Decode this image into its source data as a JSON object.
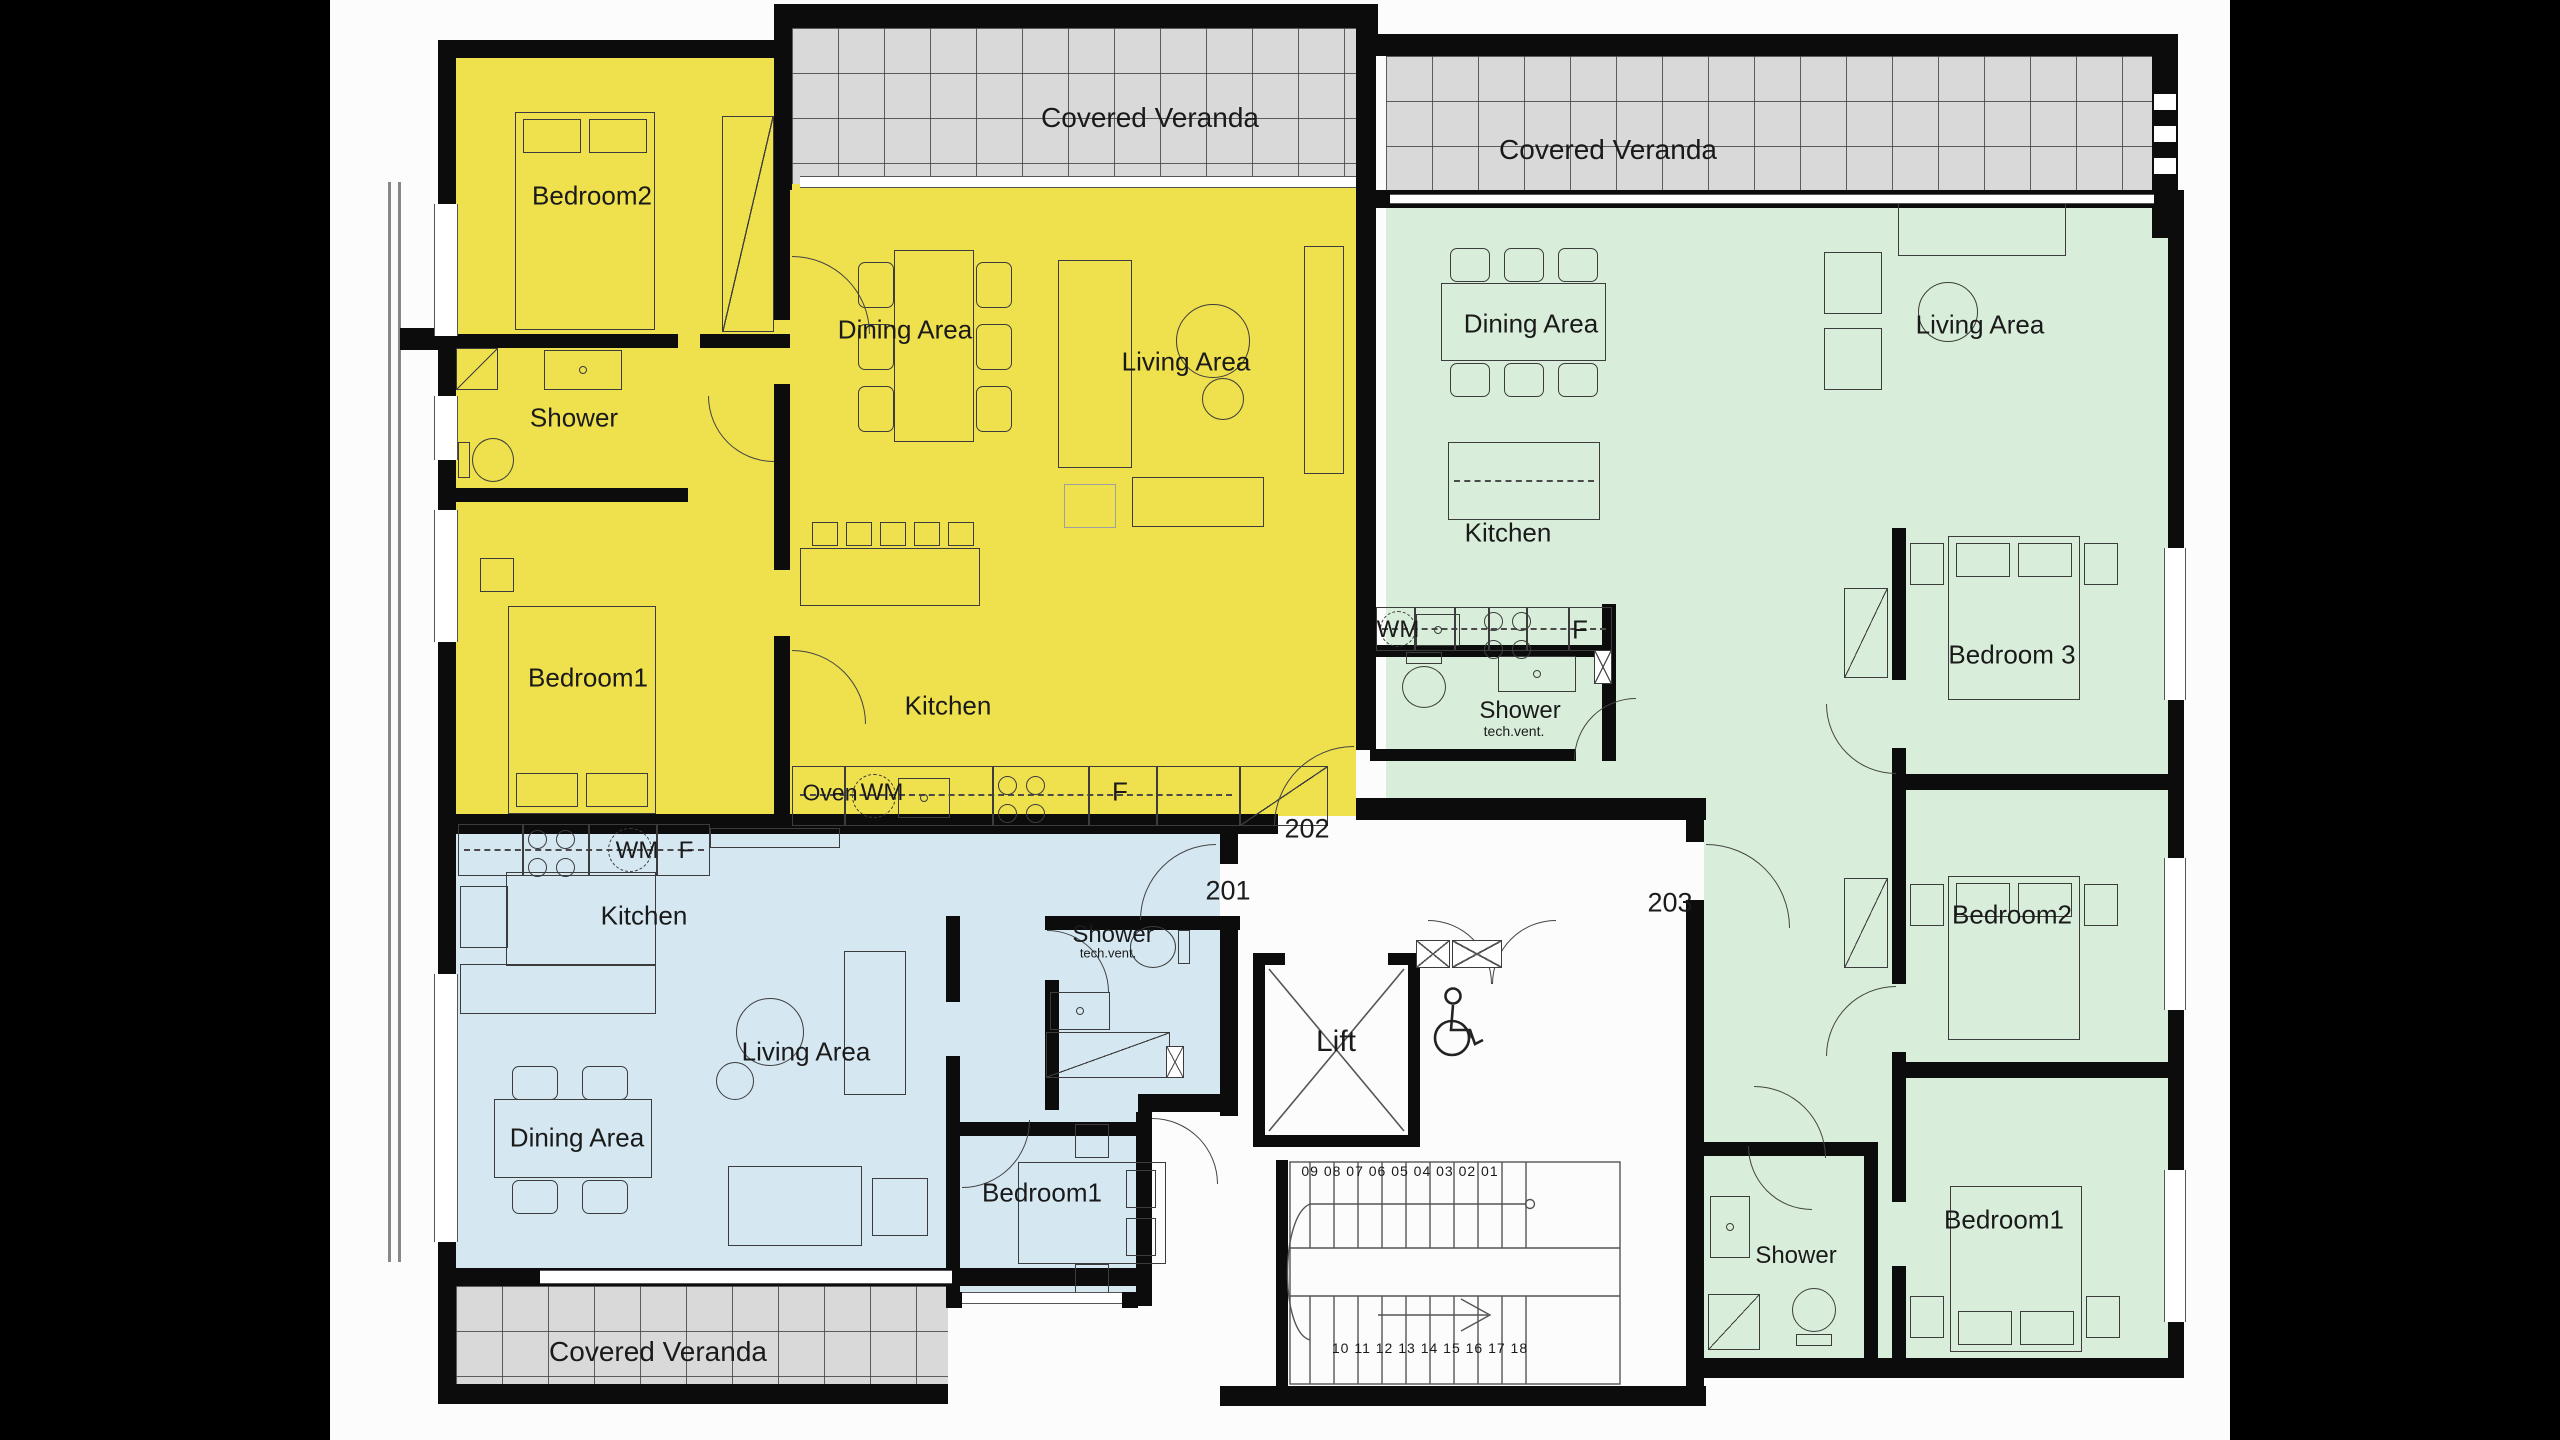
{
  "plan": {
    "verandas": {
      "top_left": "Covered Veranda",
      "top_right": "Covered Veranda",
      "bottom": "Covered Veranda"
    },
    "unit_202": {
      "number": "202",
      "rooms": {
        "bedroom2": "Bedroom2",
        "shower": "Shower",
        "bedroom1": "Bedroom1",
        "dining": "Dining Area",
        "living": "Living Area",
        "kitchen": "Kitchen"
      },
      "appliances": {
        "oven": "Oven",
        "washing_machine": "WM",
        "fridge": "F"
      }
    },
    "unit_201": {
      "number": "201",
      "rooms": {
        "kitchen": "Kitchen",
        "living": "Living Area",
        "dining": "Dining Area",
        "shower": "Shower",
        "shower_note": "tech.vent.",
        "bedroom1": "Bedroom1"
      },
      "appliances": {
        "washing_machine": "WM",
        "fridge": "F"
      }
    },
    "unit_203": {
      "number": "203",
      "rooms": {
        "dining": "Dining Area",
        "living": "Living Area",
        "kitchen": "Kitchen",
        "shower_top": "Shower",
        "shower_top_note": "tech.vent.",
        "bedroom3": "Bedroom 3",
        "bedroom2": "Bedroom2",
        "bedroom1": "Bedroom1",
        "shower_bottom": "Shower"
      },
      "appliances": {
        "washing_machine": "WM",
        "fridge": "F"
      }
    },
    "core": {
      "lift": "Lift",
      "stairs_up_numbers": "09 08 07 06 05 04 03 02 01",
      "stairs_down_numbers": "10 11 12 13 14 15 16 17 18"
    },
    "colors": {
      "unit_202": "#efe04e",
      "unit_201": "#d5e8f2",
      "unit_203": "#d9eeda",
      "veranda": "#d9d9d9",
      "wall": "#0c0c0c"
    }
  }
}
